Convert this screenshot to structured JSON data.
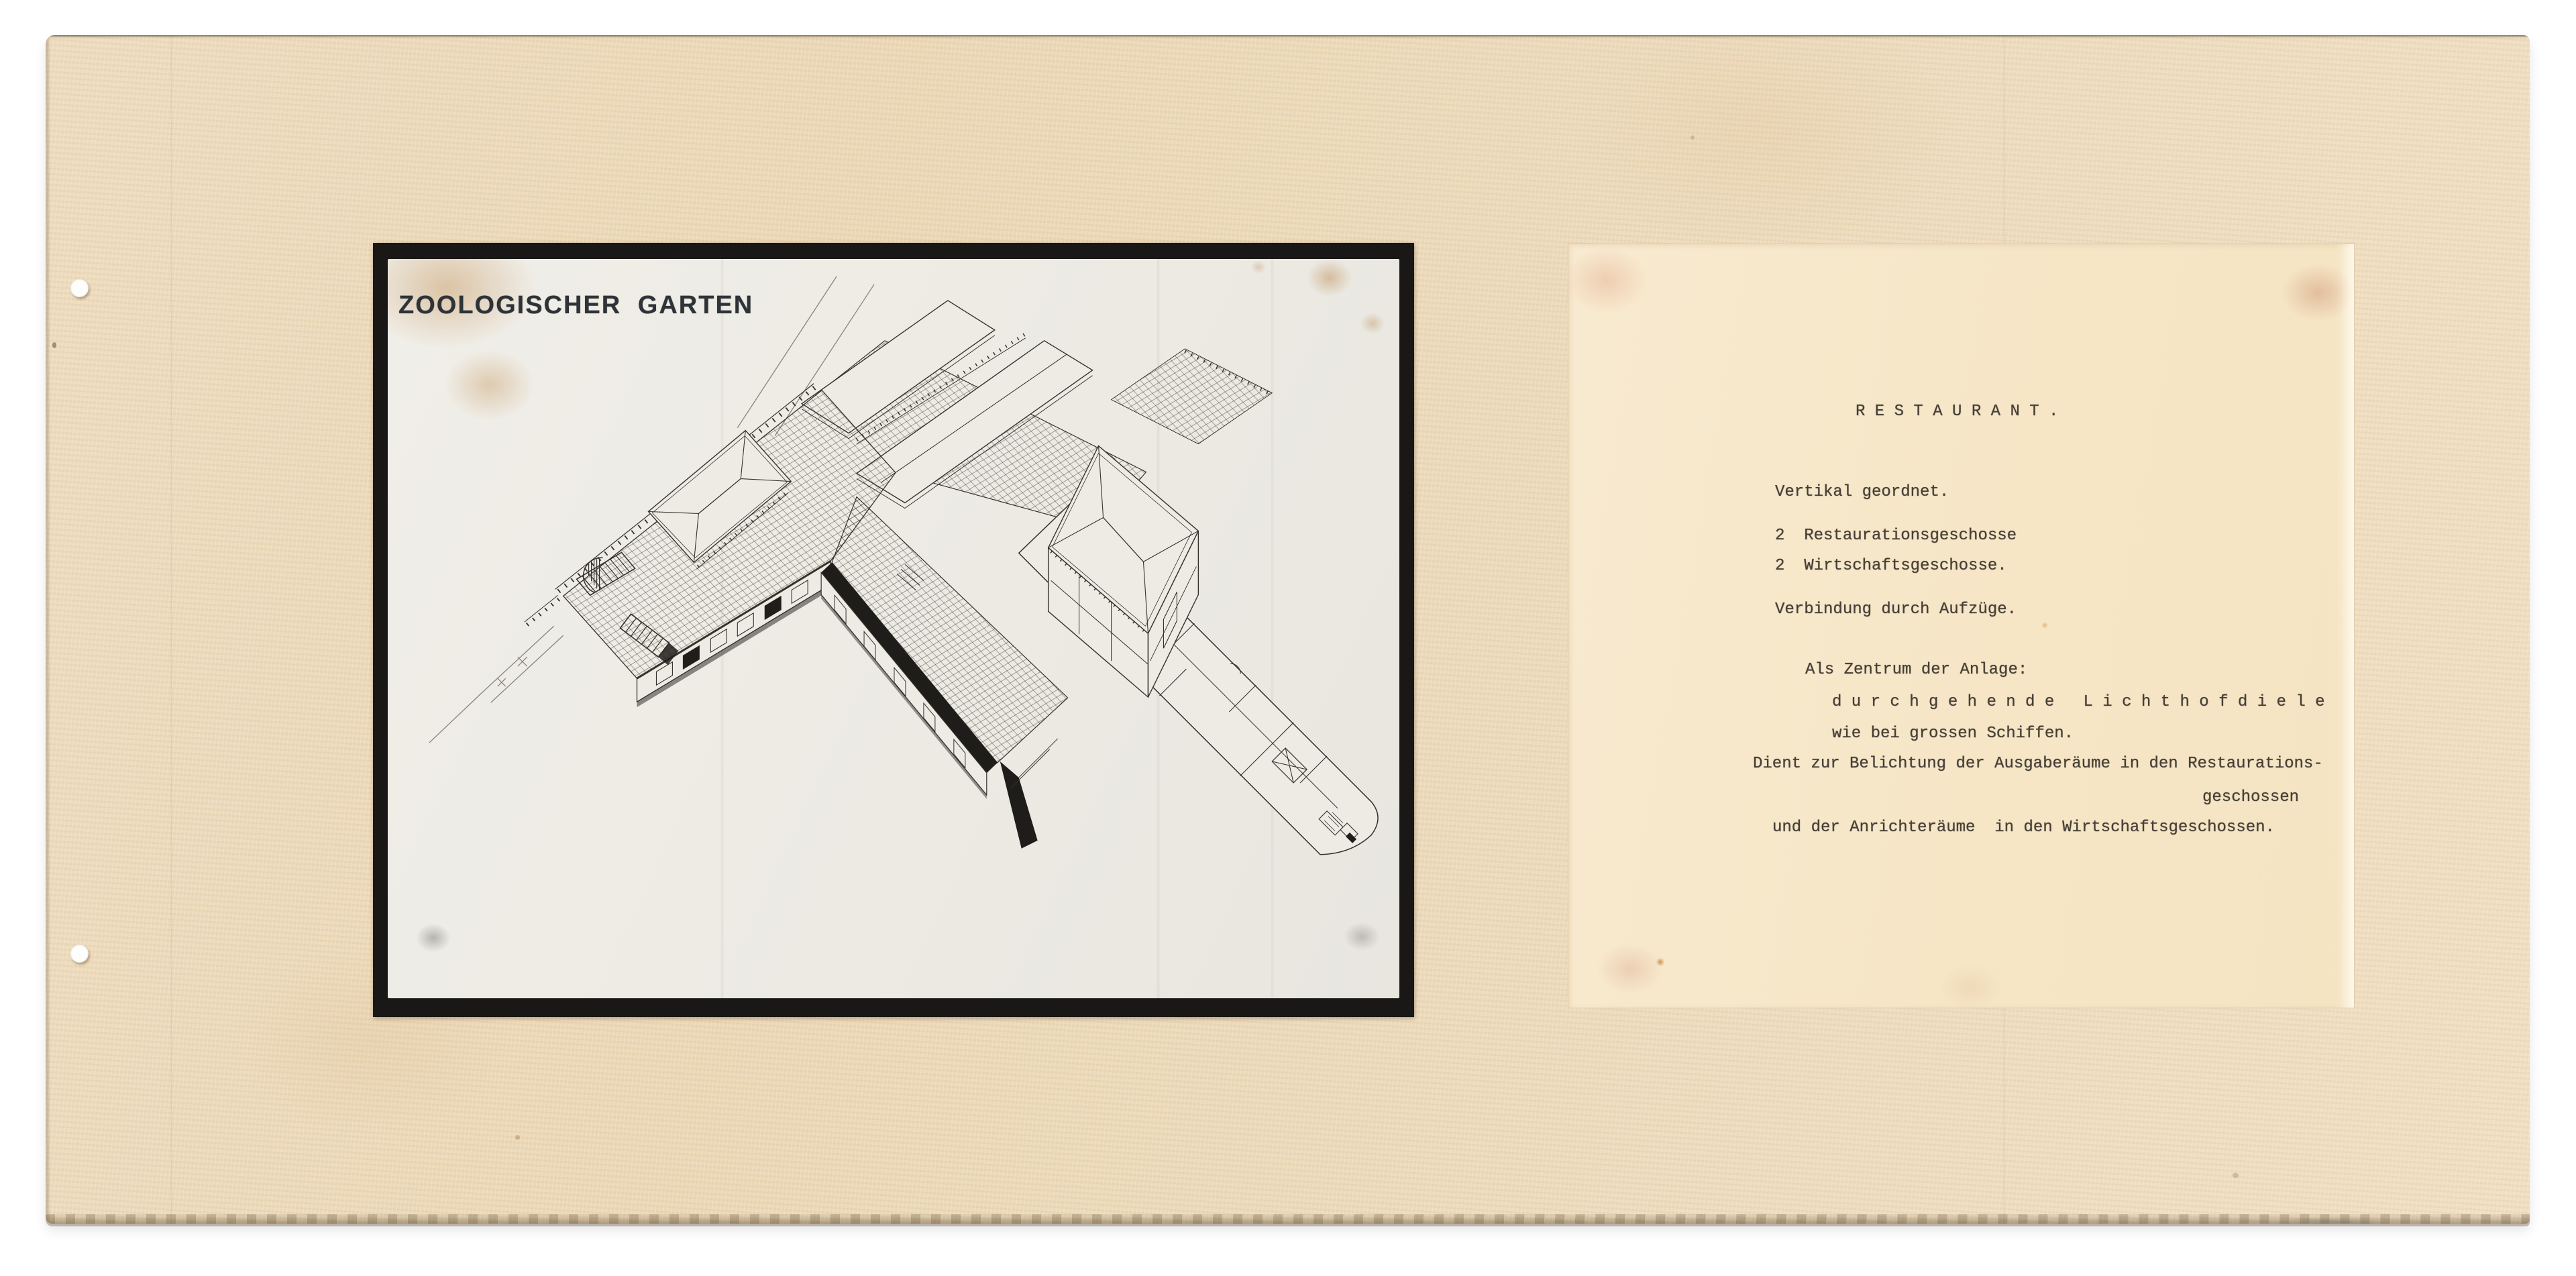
{
  "theme": {
    "board": "#ecd9ba",
    "sheet": "#f7e9cc",
    "photo_paper": "#edebe4",
    "frame": "#191816",
    "ink": "#35322c",
    "type_ink": "#453e36",
    "title_ink": "#2e3338",
    "stain": "#c79a63"
  },
  "photo": {
    "title": "ZOOLOGISCHER GARTEN"
  },
  "typed_sheet": {
    "heading": "R E S T A U R A N T .",
    "lines": [
      {
        "text": "Vertikal geordnet."
      },
      {
        "text": "2  Restaurationsgeschosse"
      },
      {
        "text": "2  Wirtschaftsgeschosse."
      },
      {
        "text": "Verbindung durch Aufzüge."
      },
      {
        "text": "Als Zentrum der Anlage:"
      },
      {
        "text": "d u r c h g e h e n d e   L i c h t h o f d i e l e"
      },
      {
        "text": "wie bei grossen Schiffen."
      },
      {
        "text": "Dient zur Belichtung der Ausgaberäume in den Restaurations-"
      },
      {
        "text": "geschossen"
      },
      {
        "text": "und der Anrichteräume  in den Wirtschaftsgeschossen."
      }
    ]
  }
}
